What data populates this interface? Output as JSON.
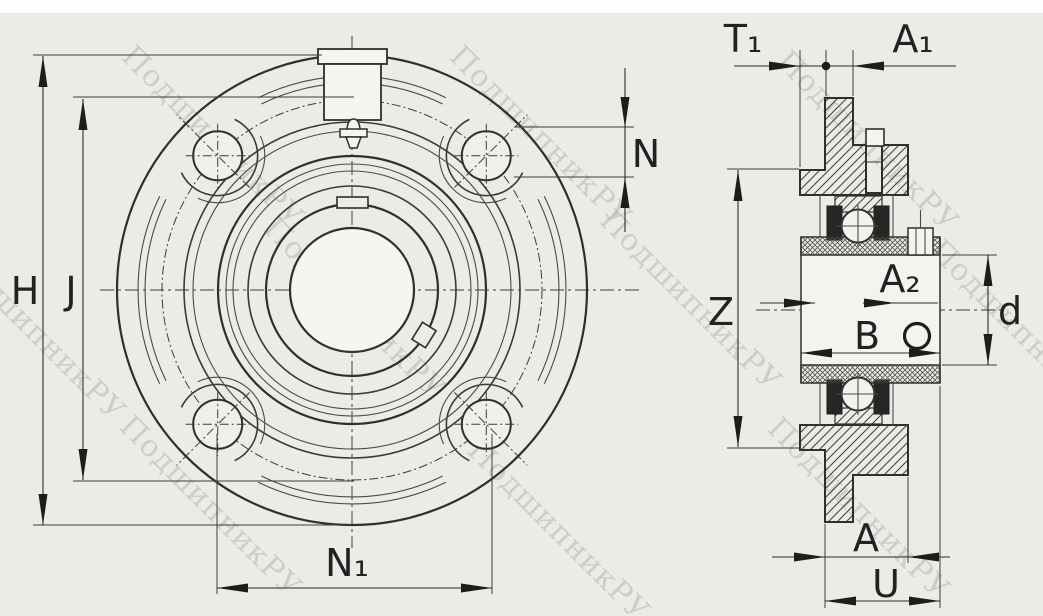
{
  "drawing": {
    "kind": "flanged-bearing-unit-technical-drawing",
    "watermark": {
      "text": "ПодшипникРУ"
    },
    "front_view": {
      "dim_labels": {
        "H": "H",
        "J": "J",
        "N": "N",
        "N1": "N₁"
      }
    },
    "section_view": {
      "dim_labels": {
        "T1": "T₁",
        "A1": "A₁",
        "A2": "A₂",
        "Z": "Z",
        "B": "B",
        "d": "d",
        "A": "A",
        "U": "U"
      }
    }
  },
  "colors": {
    "background": "#ecebe8",
    "paper_top": "#fdfdfd",
    "line": "#2f2f2d",
    "dimension": "#2b2b2b",
    "watermark": "#b7b6b4",
    "hatch": "#444442"
  }
}
